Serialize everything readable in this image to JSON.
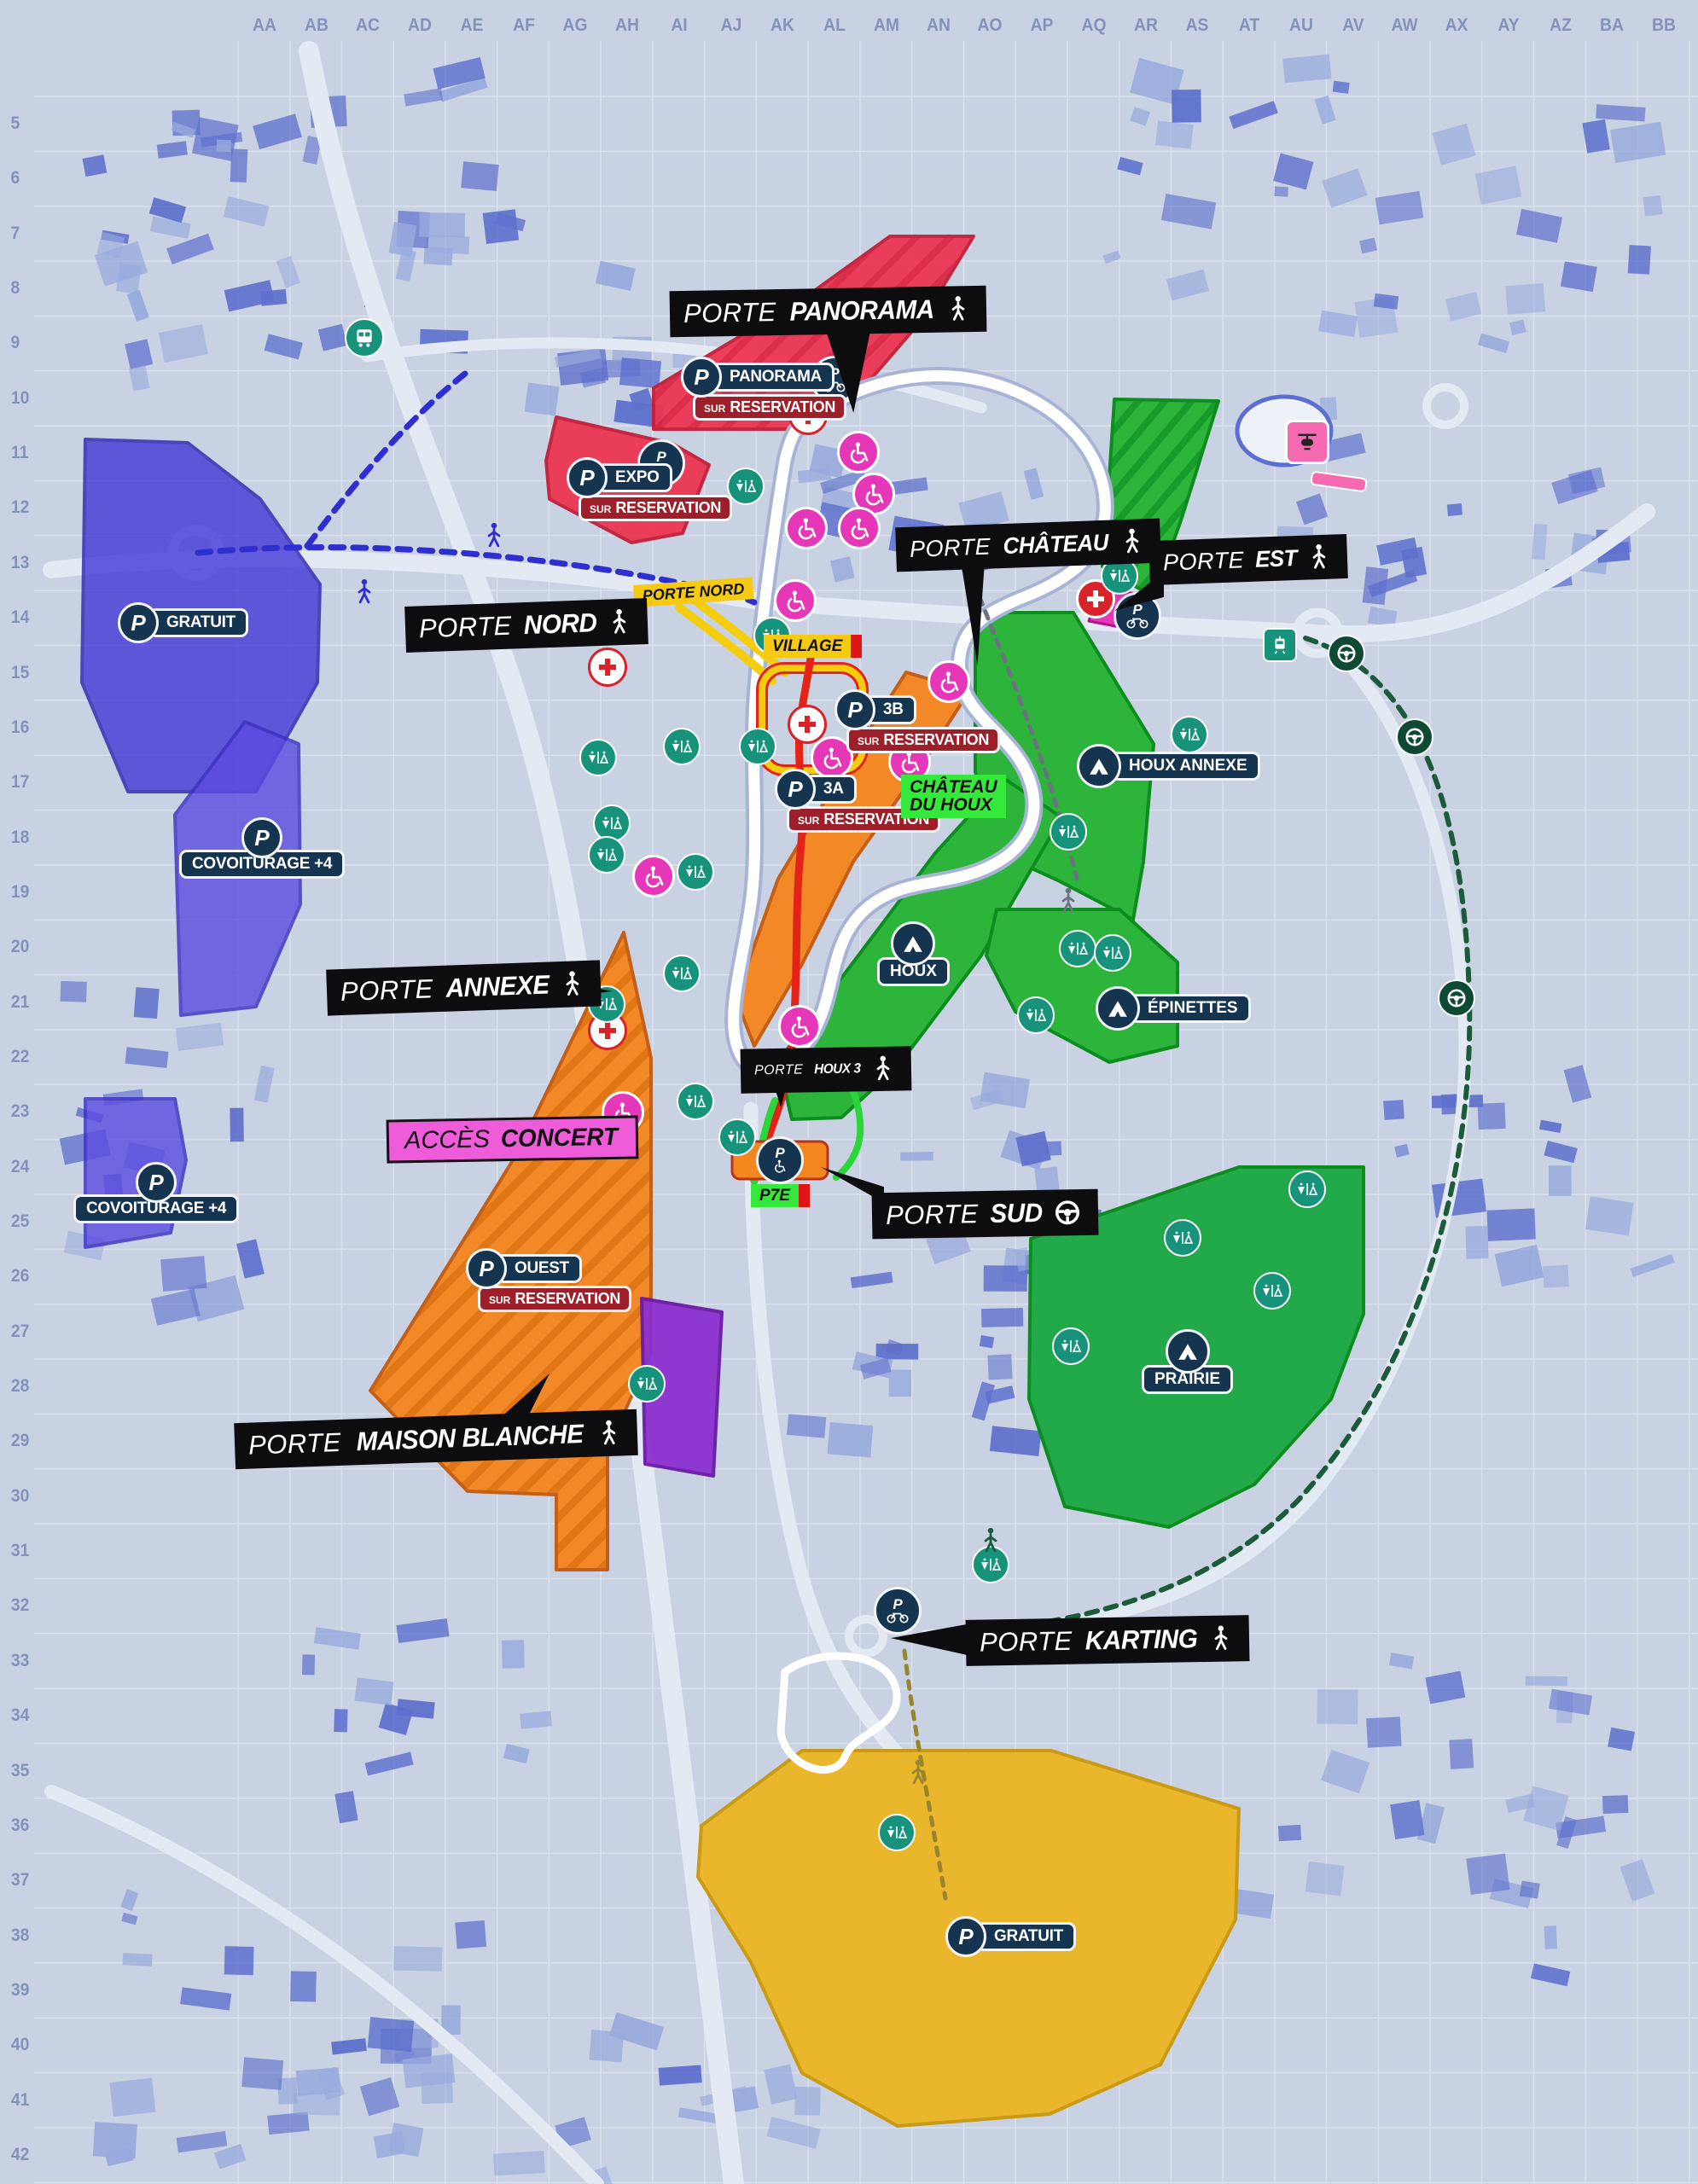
{
  "grid": {
    "columns": [
      "AA",
      "AB",
      "AC",
      "AD",
      "AE",
      "AF",
      "AG",
      "AH",
      "AI",
      "AJ",
      "AK",
      "AL",
      "AM",
      "AN",
      "AO",
      "AP",
      "AQ",
      "AR",
      "AS",
      "AT",
      "AU",
      "AV",
      "AW",
      "AX",
      "AY",
      "AZ",
      "BA",
      "BB"
    ],
    "rows": [
      "5",
      "6",
      "7",
      "8",
      "9",
      "10",
      "11",
      "12",
      "13",
      "14",
      "15",
      "16",
      "17",
      "18",
      "19",
      "20",
      "21",
      "22",
      "23",
      "24",
      "25",
      "26",
      "27",
      "28",
      "29",
      "30",
      "31",
      "32",
      "33",
      "34",
      "35",
      "36",
      "37",
      "38",
      "39",
      "40",
      "41",
      "42"
    ]
  },
  "gates": [
    {
      "id": "panorama",
      "prefix": "PORTE",
      "name": "PANORAMA",
      "access": "pedestrian"
    },
    {
      "id": "nord",
      "prefix": "PORTE",
      "name": "NORD",
      "access": "pedestrian"
    },
    {
      "id": "chateau",
      "prefix": "PORTE",
      "name": "CHÂTEAU",
      "access": "pedestrian"
    },
    {
      "id": "est",
      "prefix": "PORTE",
      "name": "EST",
      "access": "pedestrian"
    },
    {
      "id": "annexe",
      "prefix": "PORTE",
      "name": "ANNEXE",
      "access": "pedestrian"
    },
    {
      "id": "houx3",
      "prefix": "PORTE",
      "name": "HOUX 3",
      "access": "pedestrian"
    },
    {
      "id": "sud",
      "prefix": "PORTE",
      "name": "SUD",
      "access": "car"
    },
    {
      "id": "maison-blanche",
      "prefix": "PORTE",
      "name": "MAISON BLANCHE",
      "access": "pedestrian"
    },
    {
      "id": "karting",
      "prefix": "PORTE",
      "name": "KARTING",
      "access": "pedestrian"
    }
  ],
  "access": {
    "concert": {
      "prefix": "ACCÈS",
      "name": "CONCERT"
    }
  },
  "waypoints": [
    {
      "id": "porte-nord-box",
      "style": "yellow",
      "lines": [
        "PORTE NORD"
      ],
      "endbar": false
    },
    {
      "id": "village",
      "style": "yellow",
      "lines": [
        "VILLAGE"
      ],
      "endbar": true
    },
    {
      "id": "chateau-du-houx",
      "style": "green",
      "lines": [
        "CHÂTEAU",
        "DU HOUX"
      ],
      "endbar": false
    },
    {
      "id": "p7e",
      "style": "green",
      "lines": [
        "P7E"
      ],
      "endbar": true
    }
  ],
  "parkings": [
    {
      "id": "panorama",
      "label": "PANORAMA",
      "reservation": true
    },
    {
      "id": "expo",
      "label": "EXPO",
      "reservation": true
    },
    {
      "id": "3b",
      "label": "3B",
      "reservation": true
    },
    {
      "id": "3a",
      "label": "3A",
      "reservation": true
    },
    {
      "id": "ouest",
      "label": "OUEST",
      "reservation": true
    },
    {
      "id": "gratuit-nord",
      "label": "GRATUIT",
      "reservation": false
    },
    {
      "id": "covoiturage-1",
      "label": "COVOITURAGE +4",
      "reservation": false
    },
    {
      "id": "covoiturage-2",
      "label": "COVOITURAGE +4",
      "reservation": false
    },
    {
      "id": "gratuit-karting",
      "label": "GRATUIT",
      "reservation": false
    }
  ],
  "reservation": {
    "sur": "SUR",
    "word": "RESERVATION"
  },
  "p_letter": "P",
  "campings": [
    {
      "id": "houx-annexe",
      "label": "HOUX ANNEXE"
    },
    {
      "id": "houx",
      "label": "HOUX"
    },
    {
      "id": "epinettes",
      "label": "ÉPINETTES"
    },
    {
      "id": "prairie",
      "label": "PRAIRIE"
    }
  ],
  "colors": {
    "background": "#c9d2e2",
    "buildings": "#4a5fc9",
    "zone_red": "#ed3552",
    "zone_orange": "#f4861f",
    "zone_green": "#2cb53a",
    "zone_yellow": "#eab62b",
    "zone_blue": "#4438d8",
    "zone_violet": "#5b4be0",
    "zone_purple": "#8c2fd0",
    "accent_pink": "#ee5cd9",
    "pmr_magenta": "#e637b8",
    "services_teal": "#17937c",
    "chip_navy": "#14344f",
    "reservation_red": "#9c1f2a",
    "route_red": "#e42318",
    "route_yellow": "#f3cd0e",
    "route_green": "#2cd63a",
    "route_blue": "#2f2fd0",
    "route_dark_green": "#1c5b3a",
    "gate_black": "#0d0d0f"
  }
}
